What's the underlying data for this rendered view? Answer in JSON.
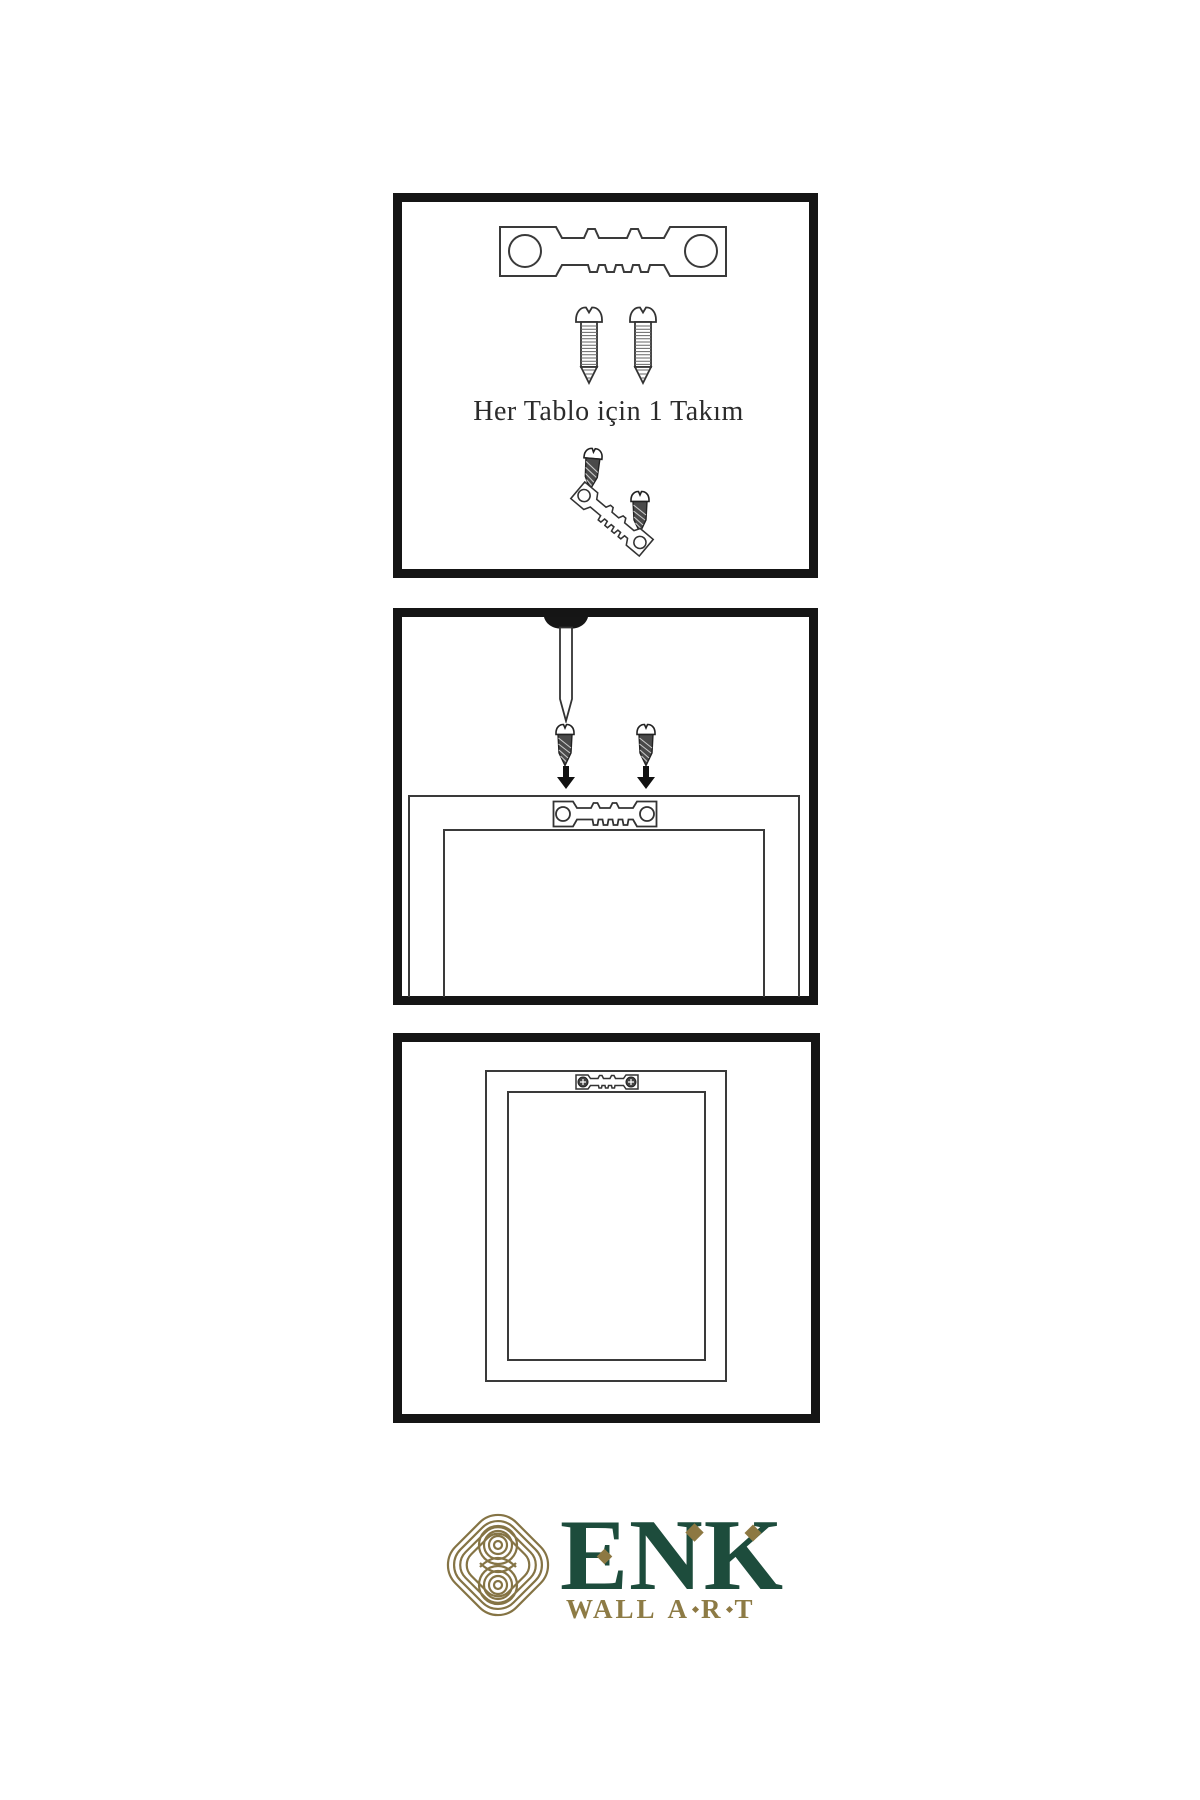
{
  "canvas": {
    "width": 1200,
    "height": 1800,
    "background": "#ffffff"
  },
  "colors": {
    "panel_border": "#151515",
    "diagram_outline": "#3a3a3a",
    "dark_metal": "#4a4a4a",
    "arrow_black": "#111111",
    "caption_text": "#2b2b2b",
    "brand_green": "#1d4c3c",
    "brand_gold": "#8d7b45",
    "knot_gold": "#857445"
  },
  "instructions": {
    "step1": {
      "caption": "Her Tablo için 1 Takım",
      "icons": [
        "sawtooth-hanger-plate",
        "mounting-screw",
        "mounting-screw",
        "screw-into-hanger-assembly"
      ]
    },
    "step2": {
      "icons": [
        "wall-nail",
        "dark-screw",
        "dark-screw",
        "down-arrow",
        "down-arrow",
        "frame-back",
        "sawtooth-hanger-on-frame"
      ]
    },
    "step3": {
      "icons": [
        "frame-back",
        "sawtooth-hanger-installed"
      ]
    }
  },
  "logo": {
    "name": "ENK",
    "subtitle": "WALL ART",
    "subtitle_parts": [
      "WALL",
      "A",
      "R",
      "T"
    ],
    "mark": "interlocking-knot"
  }
}
